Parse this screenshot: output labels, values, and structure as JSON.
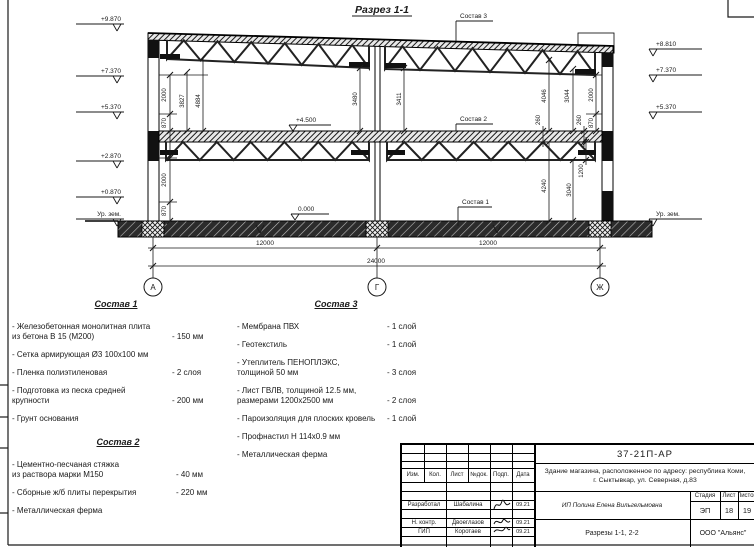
{
  "drawing": {
    "title": "Разрез 1-1",
    "levels": {
      "l9870": "+9.870",
      "l7370": "+7.370",
      "l5370": "+5.370",
      "l2870": "+2.870",
      "l0870": "+0.870",
      "lground": "Ур. зем.",
      "r8810": "+8.810",
      "r7370": "+7.370",
      "r5370": "+5.370",
      "rground": "Ур. зем.",
      "floor2": "+4.500",
      "floor1": "0.000"
    },
    "dims": {
      "w870": "870",
      "w2000": "2000",
      "d3827": "3827",
      "d4884": "4884",
      "d3480": "3480",
      "d3411": "3411",
      "d4046": "4046",
      "d3044": "3044",
      "d260": "260",
      "d4240": "4240",
      "d3040": "3040",
      "d1200": "1200",
      "span": "12000",
      "total": "24000"
    },
    "axes": {
      "a": "А",
      "g": "Г",
      "j": "Ж"
    },
    "labels": {
      "c1": "Состав 1",
      "c2": "Состав 2",
      "c3": "Состав 3"
    }
  },
  "legend": {
    "sections": [
      {
        "title": "Состав 1",
        "items": [
          {
            "name": "- Железобетонная  монолитная плита\n  из бетона В 15 (М200)",
            "value": "- 150 мм"
          },
          {
            "name": "- Сетка армирующая Ø3 100х100 мм",
            "value": ""
          },
          {
            "name": "- Пленка полиэтиленовая",
            "value": "-  2 слоя"
          },
          {
            "name": "- Подготовка из песка средней\n  крупности",
            "value": "- 200 мм"
          },
          {
            "name": "- Грунт основания",
            "value": ""
          }
        ]
      },
      {
        "title": "Состав 2",
        "items": [
          {
            "name": "- Цементно-песчаная стяжка\n  из раствора марки М150",
            "value": "- 40 мм"
          },
          {
            "name": "- Сборные ж/б плиты перекрытия",
            "value": "- 220 мм"
          },
          {
            "name": "- Металлическая ферма",
            "value": ""
          }
        ]
      },
      {
        "title": "Состав 3",
        "items": [
          {
            "name": "- Мембрана ПВХ",
            "value": "- 1 слой"
          },
          {
            "name": "- Геотекстиль",
            "value": "- 1 слой"
          },
          {
            "name": "- Утеплитель ПЕНОПЛЭКС,\n  толщиной 50 мм",
            "value": "- 3 слоя"
          },
          {
            "name": "- Лист ГВЛВ, толщиной 12.5 мм,\n  размерами 1200х2500 мм",
            "value": "- 2 слоя"
          },
          {
            "name": "- Пароизоляция для плоских кровель",
            "value": "- 1 слой"
          },
          {
            "name": "- Профнастил Н 114х0.9 мм",
            "value": ""
          },
          {
            "name": "- Металлическая ферма",
            "value": ""
          }
        ]
      }
    ]
  },
  "titleblock": {
    "doc_number": "37-21П-АР",
    "project": "Здание магазина, расположенное по адресу: республика Коми,\nг. Сыктывкар, ул. Северная, д.83",
    "columns": [
      "Изм.",
      "Кол.",
      "Лист",
      "№док.",
      "Подп.",
      "Дата"
    ],
    "rows": [
      {
        "role": "Разработал",
        "name": "Шабалина",
        "date": "09.21"
      },
      {
        "role": "Н. контр.",
        "name": "Двоеглазов",
        "date": "09.21"
      },
      {
        "role": "ГИП",
        "name": "Коротаев",
        "date": "09.21"
      }
    ],
    "client": "ИП Полина Елена Вильгельмовна",
    "stage_label": "Стадия",
    "sheet_label": "Лист",
    "sheets_label": "Листов",
    "stage": "ЭП",
    "sheet": "18",
    "sheets": "19",
    "sheet_title": "Разрезы 1-1, 2-2",
    "company": "ООО \"Альянс\""
  }
}
